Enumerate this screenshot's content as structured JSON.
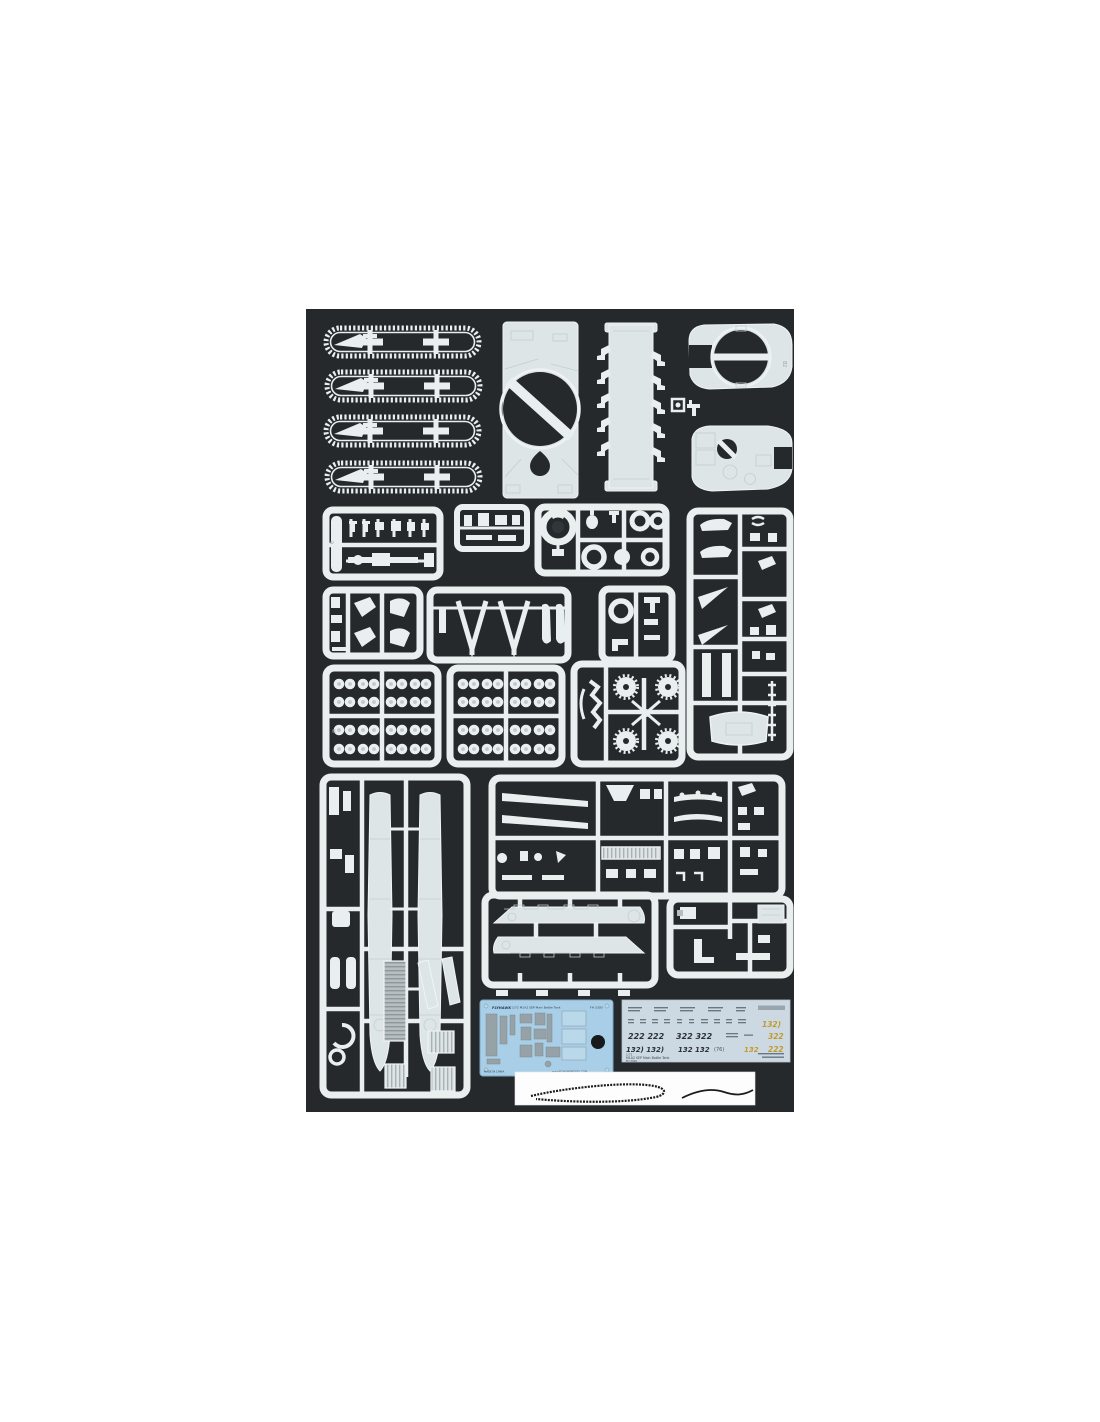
{
  "photo": {
    "description": "Flat-lay product photo of a 1/72 plastic model kit: white styrene sprues of an M1A2 SEP main battle tank (tracks, hull, turret, road wheels, side skirts, detail runners), a blue photo-etch fret, a decal sheet and a tow-cable strip on a dark charcoal background",
    "colors": {
      "page_bg": "#ffffff",
      "photo_bg": "#26292b",
      "sprue_white": "#e9eeef",
      "piece_grey": "#dde5e7",
      "pe_card": "#a8cfe7",
      "pe_part": "#96a2a7",
      "decal_sheet": "#cdd9e2",
      "decal_ink": "#2b3036",
      "decal_yellow": "#c19a2e",
      "cable_strip": "#fdfdfd"
    }
  },
  "pe_fret": {
    "brand": "FLYHAWK",
    "title": "1/72 M1A2 SEP Main Battle Tank",
    "code": "FH 3300",
    "footer_left": "MADE IN CHINA",
    "footer_right": "www.FLYHAWKMODEL.COM"
  },
  "decal_sheet": {
    "scale": "1/72",
    "title": "M1A2 SEP Main Battle Tank",
    "code": "FH 3300",
    "numbers": {
      "row3_a": "222 222",
      "row3_b": "322 322",
      "row4_a": "132) 132)",
      "row4_b": "132 132",
      "row4_c": "(76)",
      "yellow_row2": "132)",
      "yellow_row3": "322",
      "yellow_row4_a": "132",
      "yellow_row4_b": "222"
    }
  }
}
